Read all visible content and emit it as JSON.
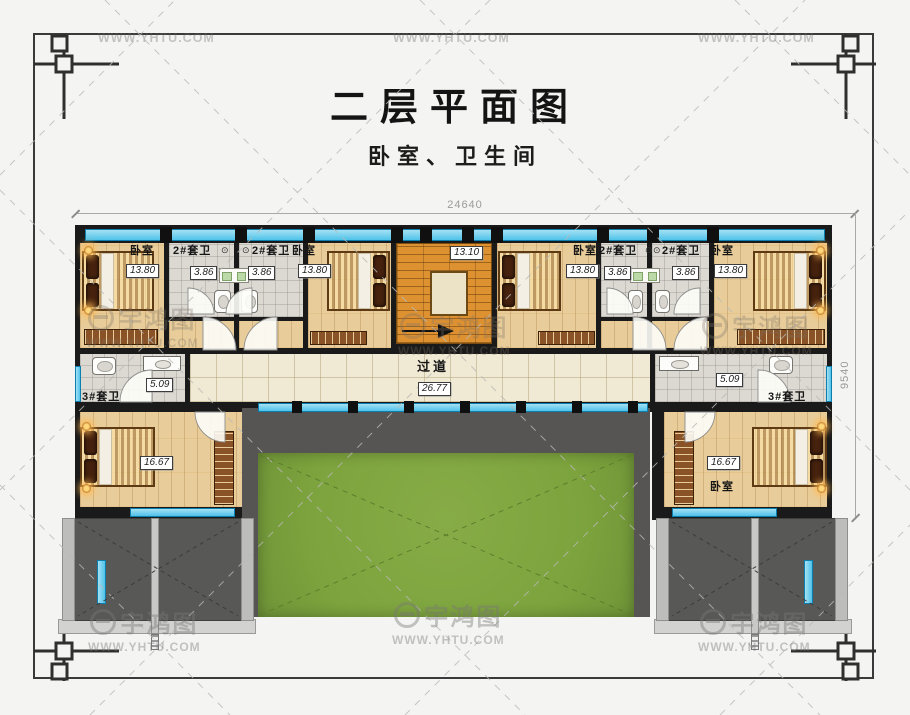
{
  "header": {
    "title": "二层平面图",
    "subtitle": "卧室、卫生间"
  },
  "dimensions": {
    "overall_width": "24640",
    "overall_depth": "9540"
  },
  "watermark": {
    "brand": "宇鸿图",
    "site": "WWW.YHTU.COM"
  },
  "icons": {
    "ceiling_lamp": "⊙"
  },
  "rooms": {
    "bedroom_top_left": {
      "label": "卧室",
      "area": "13.80"
    },
    "suite_bath_1": {
      "label": "2#套卫",
      "area": "3.86"
    },
    "suite_bath_2": {
      "label": "2#套卫",
      "area": "3.86"
    },
    "bedroom_mid_left": {
      "label": "卧室",
      "area": "13.80"
    },
    "staircase": {
      "area": "13.10"
    },
    "bedroom_mid_right": {
      "label": "卧室",
      "area": "13.80"
    },
    "suite_bath_3": {
      "label": "2#套卫",
      "area": "3.86"
    },
    "suite_bath_4": {
      "label": "2#套卫",
      "area": "3.86"
    },
    "bedroom_top_right": {
      "label": "卧室",
      "area": "13.80"
    },
    "suite_bath_left": {
      "label": "3#套卫",
      "area": "5.09"
    },
    "corridor": {
      "label": "过道",
      "area": "26.77"
    },
    "suite_bath_right": {
      "label": "3#套卫",
      "area": "5.09"
    },
    "bedroom_bottom_left": {
      "area": "16.67"
    },
    "bedroom_bottom_right": {
      "label": "卧室",
      "area": "16.67"
    }
  },
  "colors": {
    "bg": "#f4f4f2",
    "wall": "#1a1a1a",
    "wood": "#e8cd9a",
    "tile": "#dcd9d3",
    "corridor": "#f0e9d3",
    "stair": "#de9130",
    "lawn": "#7ca33d",
    "roof": "#575553",
    "window": "#4fc2ea"
  }
}
